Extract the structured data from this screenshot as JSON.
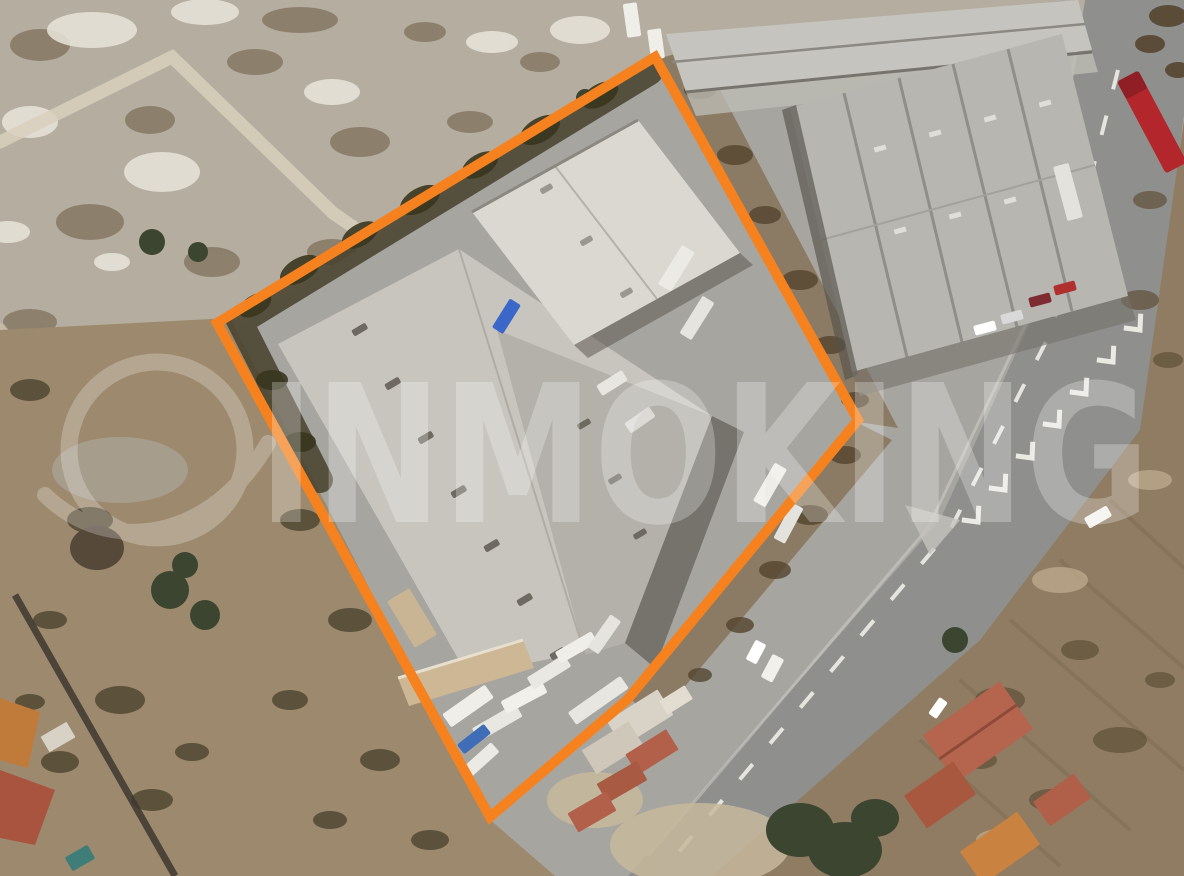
{
  "image": {
    "type": "satellite-aerial-photo",
    "subject": "industrial-warehouse-property-with-boundary-overlay"
  },
  "watermark": {
    "text": "INMOKING",
    "logo": "circle-swoosh-logo",
    "color": "#ffffff",
    "opacity": 0.26
  },
  "outline": {
    "color": "#F5821F",
    "stroke_width": 10,
    "points": "655,57 858,420 627,700 490,817 217,323"
  },
  "palette": {
    "scrub_top_left": "#b5ad9f",
    "field_left": "#9d8a6e",
    "field_bottom_right": "#8f7c63",
    "dirt_strip": "#8c7b64",
    "asphalt": "#a7a5a0",
    "road": "#8f8f8d",
    "road_marking": "#f5f3ed",
    "warehouse_roof": "#c8c5be",
    "warehouse_wing": "#b4b1aa",
    "white_building": "#dbd8d1",
    "right_building": "#b8b6b0",
    "top_strip_building": "#c6c4be",
    "annex_roof": "#cdb795",
    "vegetation": "#473f2b",
    "tree_green": "#3c4530",
    "red_roof": "#b2604a",
    "orange_roof": "#c9823f",
    "red_truck": "#b3262c",
    "blue_truck": "#3a67c8",
    "pool": "#3e7d78",
    "shadow": "#55514a"
  }
}
